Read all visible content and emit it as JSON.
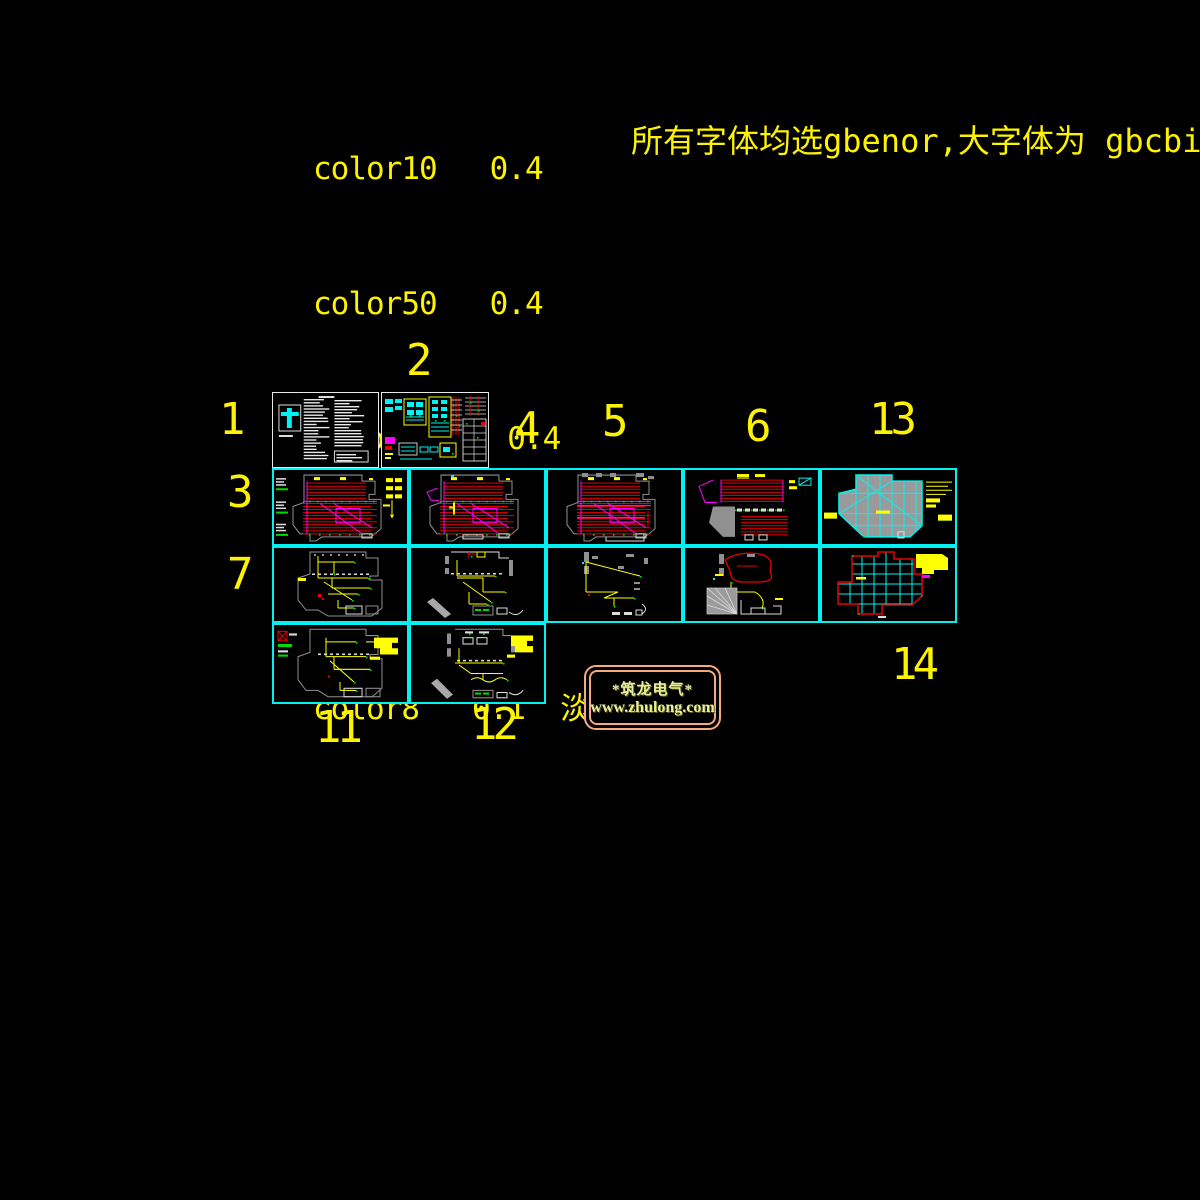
{
  "pen_notes": {
    "lines": [
      "color10   0.4",
      "color50   0.4",
      "color130   0.4",
      "color210   0.4",
      "color8   0.1  淡显 80%"
    ]
  },
  "font_note": "所有字体均选gbenor,大字体为 gbcbig",
  "figure_labels": [
    {
      "text": "1"
    },
    {
      "text": "2"
    },
    {
      "text": "3"
    },
    {
      "text": "4"
    },
    {
      "text": "5"
    },
    {
      "text": "6"
    },
    {
      "text": "7"
    },
    {
      "text": "11"
    },
    {
      "text": "12"
    },
    {
      "text": "13"
    },
    {
      "text": "14"
    }
  ],
  "panels": [
    {
      "id": "1",
      "kind": "notes"
    },
    {
      "id": "2",
      "kind": "schematic"
    },
    {
      "id": "3",
      "kind": "planRedA"
    },
    {
      "id": "4",
      "kind": "planRedB"
    },
    {
      "id": "5",
      "kind": "planRedC"
    },
    {
      "id": "6",
      "kind": "planRedD"
    },
    {
      "id": "13",
      "kind": "planGrayGrid"
    },
    {
      "id": "7",
      "kind": "planYellowA"
    },
    {
      "id": "8",
      "kind": "planYellowB"
    },
    {
      "id": "9",
      "kind": "planYellowC"
    },
    {
      "id": "10",
      "kind": "planRedCurve"
    },
    {
      "id": "14",
      "kind": "planRedGrid"
    },
    {
      "id": "11",
      "kind": "planYellowD"
    },
    {
      "id": "12",
      "kind": "planYellowE"
    }
  ],
  "logo": {
    "line1": "*筑龙电气*",
    "line2": "www.zhulong.com"
  },
  "colors": {
    "background": "#000000",
    "cad_yellow": "#FFFF00",
    "grid_cyan": "#00F2F2",
    "wiring_red": "#E80000",
    "wiring_magenta": "#FF00FF",
    "wall_gray": "#909090",
    "device_green": "#00D800",
    "panel_white": "#E8E8E8",
    "logo_border": "#F5A97E",
    "logo_text": "#E9EF9D"
  }
}
